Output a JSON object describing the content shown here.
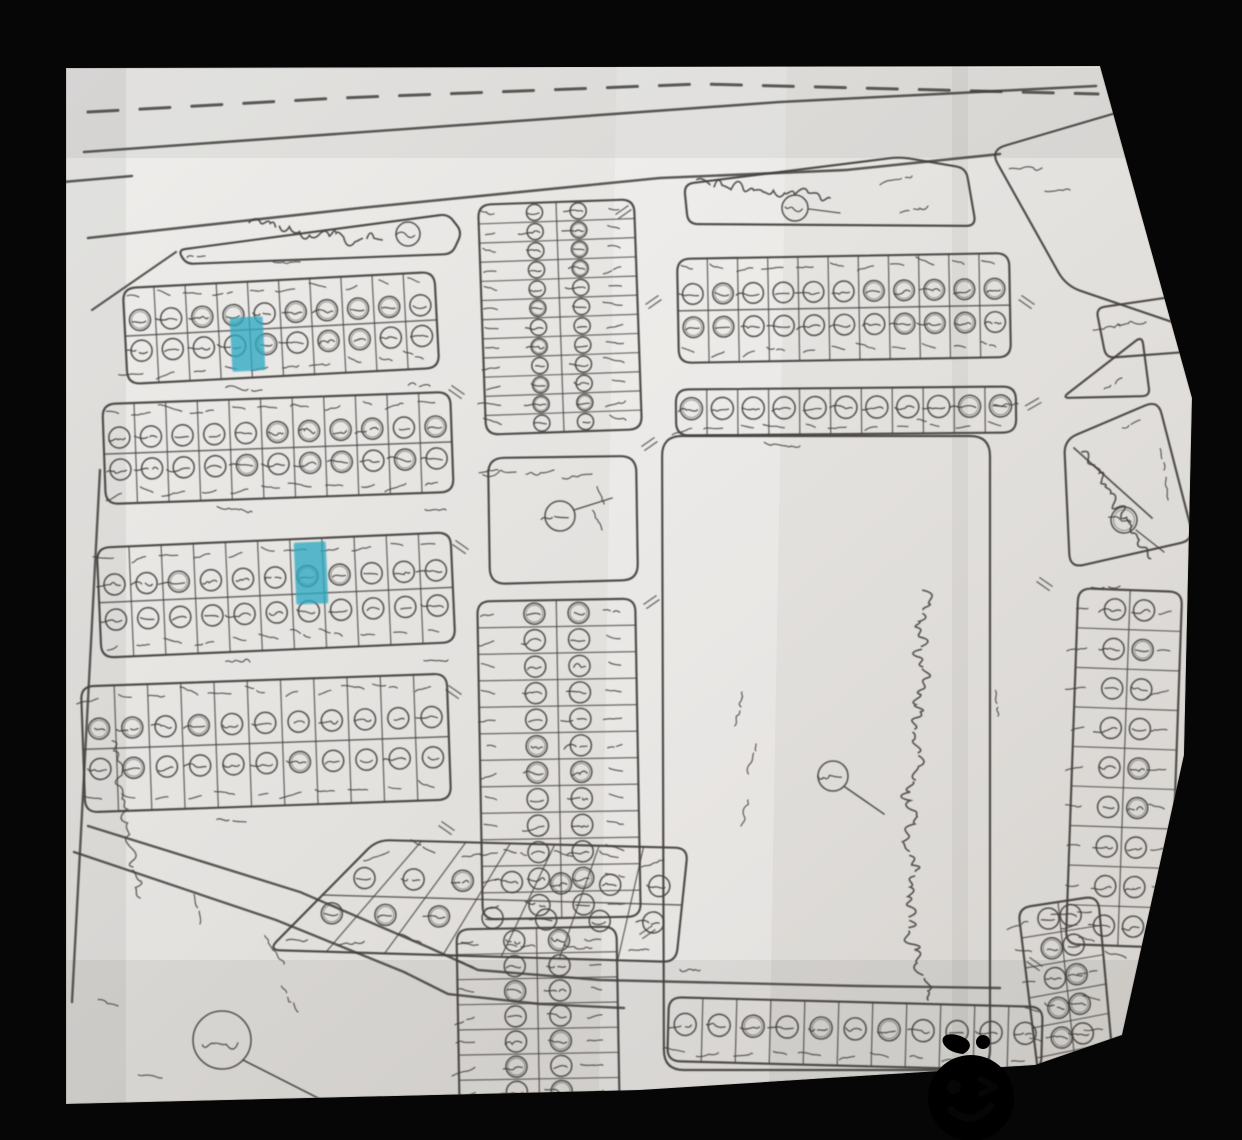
{
  "meta": {
    "kind": "scanned hand-drawn cadastral plot map photographed on a black background",
    "script": "Arabic / Kurdish handwriting"
  },
  "palette": {
    "background": "#060606",
    "paper_light": "#efeeec",
    "paper_mid": "#e4e2df",
    "paper_dark": "#d7d4d0",
    "ink": "#413f3c",
    "highlight": "#2fa9c2",
    "red_note": "#d9484f",
    "marker": "#141414",
    "logo_orange": "#fd4e02"
  },
  "paper": {
    "outline": [
      [
        66,
        68
      ],
      [
        1100,
        66
      ],
      [
        1192,
        398
      ],
      [
        1184,
        755
      ],
      [
        1122,
        1035
      ],
      [
        1035,
        1065
      ],
      [
        640,
        1090
      ],
      [
        66,
        1104
      ]
    ]
  },
  "roads": [
    {
      "name": "highway-dashed-centerline",
      "points": [
        [
          88,
          112
        ],
        [
          340,
          98
        ],
        [
          700,
          84
        ],
        [
          1098,
          94
        ]
      ],
      "width": 3,
      "dash": [
        30,
        22
      ]
    },
    {
      "name": "highway-north-edge",
      "points": [
        [
          84,
          152
        ],
        [
          420,
          128
        ],
        [
          780,
          102
        ],
        [
          1096,
          86
        ]
      ],
      "width": 2.6
    },
    {
      "name": "highway-south-edge",
      "points": [
        [
          88,
          238
        ],
        [
          360,
          208
        ],
        [
          660,
          178
        ],
        [
          846,
          170
        ],
        [
          1000,
          154
        ]
      ],
      "width": 2.6
    },
    {
      "name": "west-spur",
      "points": [
        [
          92,
          310
        ],
        [
          176,
          252
        ]
      ],
      "width": 2.2
    },
    {
      "name": "west-boundary",
      "points": [
        [
          100,
          470
        ],
        [
          88,
          700
        ],
        [
          72,
          1002
        ]
      ],
      "width": 2.4
    },
    {
      "name": "sw-road-upper",
      "points": [
        [
          88,
          826
        ],
        [
          300,
          892
        ],
        [
          430,
          948
        ],
        [
          478,
          970
        ],
        [
          600,
          980
        ],
        [
          860,
          986
        ],
        [
          1000,
          988
        ]
      ],
      "width": 2.4
    },
    {
      "name": "sw-road-lower",
      "points": [
        [
          74,
          852
        ],
        [
          276,
          920
        ],
        [
          404,
          972
        ],
        [
          448,
          994
        ],
        [
          540,
          1004
        ],
        [
          624,
          1008
        ]
      ],
      "width": 2.4
    },
    {
      "name": "left-edge-dash",
      "points": [
        [
          63,
          182
        ],
        [
          132,
          176
        ]
      ],
      "width": 2.4
    }
  ],
  "blocks": [
    {
      "id": "block-a",
      "kind": "grid",
      "rect": [
        125,
        280,
        312,
        96
      ],
      "rot": -3,
      "cols": 10,
      "rows": 2,
      "layout": "rows2"
    },
    {
      "id": "block-b",
      "kind": "grid",
      "rect": [
        104,
        398,
        348,
        100
      ],
      "rot": -2,
      "cols": 11,
      "rows": 2,
      "layout": "rows2"
    },
    {
      "id": "block-c",
      "kind": "grid",
      "rect": [
        99,
        540,
        354,
        110
      ],
      "rot": -2.5,
      "cols": 11,
      "rows": 2,
      "layout": "rows2"
    },
    {
      "id": "block-d",
      "kind": "grid",
      "rect": [
        83,
        680,
        366,
        126
      ],
      "rot": -2,
      "cols": 11,
      "rows": 2,
      "layout": "rows2"
    },
    {
      "id": "strip-north",
      "kind": "grid",
      "rect": [
        482,
        202,
        156,
        230
      ],
      "rot": -2,
      "cols": 2,
      "rows": 12,
      "layout": "cols2"
    },
    {
      "id": "mosque-square",
      "kind": "outline",
      "corners": [
        [
          488,
          458
        ],
        [
          636,
          456
        ],
        [
          638,
          580
        ],
        [
          490,
          584
        ]
      ],
      "radius": 16,
      "marks": [
        {
          "kind": "circle",
          "x": 560,
          "y": 516,
          "r": 15
        },
        {
          "kind": "line",
          "pts": [
            [
              574,
              510
            ],
            [
              612,
              498
            ]
          ],
          "w": 1.4
        },
        {
          "kind": "squiggle",
          "x": 516,
          "y": 472,
          "s": 12,
          "rot": -5
        },
        {
          "kind": "squiggle",
          "x": 554,
          "y": 470,
          "s": 11,
          "rot": -5
        },
        {
          "kind": "squiggle",
          "x": 592,
          "y": 474,
          "s": 11,
          "rot": -3
        },
        {
          "kind": "squiggle",
          "x": 498,
          "y": 470,
          "s": 7,
          "rot": 0
        },
        {
          "kind": "squiggle",
          "x": 604,
          "y": 504,
          "s": 8,
          "rot": 70
        },
        {
          "kind": "squiggle",
          "x": 602,
          "y": 530,
          "s": 8,
          "rot": 70
        }
      ]
    },
    {
      "id": "strip-mid",
      "kind": "grid",
      "rect": [
        480,
        600,
        158,
        318
      ],
      "rot": -1,
      "cols": 2,
      "rows": 12,
      "layout": "cols2"
    },
    {
      "id": "strip-south",
      "kind": "grid",
      "rect": [
        458,
        928,
        160,
        176
      ],
      "rot": -1,
      "cols": 2,
      "rows": 7,
      "layout": "cols2"
    },
    {
      "id": "block-f",
      "kind": "grid",
      "rect": [
        678,
        256,
        332,
        104
      ],
      "rot": -1,
      "cols": 11,
      "rows": 2,
      "layout": "rows2"
    },
    {
      "id": "row-g",
      "kind": "grid",
      "rect": [
        676,
        388,
        340,
        46
      ],
      "rot": -0.5,
      "cols": 11,
      "rows": 1,
      "layout": "single"
    },
    {
      "id": "field",
      "kind": "outline",
      "corners": [
        [
          662,
          436
        ],
        [
          990,
          436
        ],
        [
          990,
          1070
        ],
        [
          664,
          1070
        ]
      ],
      "radius": 20,
      "marks": [
        {
          "kind": "squiggle",
          "x": 800,
          "y": 446,
          "s": 15,
          "rot": 0
        },
        {
          "kind": "script",
          "x": 928,
          "y": 1000,
          "len": 400,
          "rot": 90,
          "size": 13
        },
        {
          "kind": "squiggle",
          "x": 742,
          "y": 692,
          "s": 13,
          "rot": -75
        },
        {
          "kind": "squiggle",
          "x": 756,
          "y": 744,
          "s": 11,
          "rot": -75
        },
        {
          "kind": "squiggle",
          "x": 748,
          "y": 800,
          "s": 12,
          "rot": -75
        },
        {
          "kind": "circle",
          "x": 833,
          "y": 776,
          "r": 15
        },
        {
          "kind": "line",
          "pts": [
            [
              845,
              787
            ],
            [
              884,
              814
            ]
          ],
          "w": 1.6
        }
      ]
    },
    {
      "id": "row-h",
      "kind": "grid",
      "rect": [
        668,
        1002,
        374,
        64
      ],
      "rot": 1.5,
      "cols": 11,
      "rows": 1,
      "layout": "single"
    },
    {
      "id": "block-e",
      "kind": "gridq",
      "corners": [
        [
          377,
          840
        ],
        [
          688,
          848
        ],
        [
          676,
          962
        ],
        [
          268,
          950
        ]
      ],
      "cols": 7,
      "rows": 2,
      "layout": "rows2"
    },
    {
      "id": "sliver",
      "kind": "outline",
      "corners": [
        [
          178,
          250
        ],
        [
          448,
          214
        ],
        [
          462,
          232
        ],
        [
          452,
          254
        ],
        [
          186,
          264
        ]
      ],
      "radius": 8,
      "marks": [
        {
          "kind": "script",
          "x": 382,
          "y": 240,
          "len": 130,
          "rot": 6,
          "size": 8
        },
        {
          "kind": "circle",
          "x": 408,
          "y": 234,
          "r": 12
        }
      ]
    },
    {
      "id": "north-trap",
      "kind": "outline",
      "corners": [
        [
          684,
          184
        ],
        [
          900,
          157
        ],
        [
          966,
          168
        ],
        [
          976,
          226
        ],
        [
          688,
          224
        ]
      ],
      "radius": 10,
      "marks": [
        {
          "kind": "script",
          "x": 830,
          "y": 198,
          "len": 120,
          "rot": 8,
          "size": 9
        },
        {
          "kind": "circle",
          "x": 795,
          "y": 208,
          "r": 13
        },
        {
          "kind": "line",
          "pts": [
            [
              809,
              209
            ],
            [
              840,
              213
            ]
          ],
          "w": 1.3
        },
        {
          "kind": "squiggle",
          "x": 912,
          "y": 176,
          "s": 11,
          "rot": -20
        },
        {
          "kind": "squiggle",
          "x": 928,
          "y": 206,
          "s": 11,
          "rot": -20
        }
      ]
    },
    {
      "id": "ne-block",
      "kind": "outline",
      "corners": [
        [
          990,
          150
        ],
        [
          1150,
          103
        ],
        [
          1196,
          330
        ],
        [
          1066,
          286
        ]
      ],
      "radius": 16,
      "marks": [
        {
          "kind": "squiggle",
          "x": 1042,
          "y": 168,
          "s": 13,
          "rot": -10
        },
        {
          "kind": "squiggle",
          "x": 1070,
          "y": 190,
          "s": 11,
          "rot": -10
        }
      ]
    },
    {
      "id": "ne-corner",
      "kind": "outline",
      "corners": [
        [
          1096,
          308
        ],
        [
          1178,
          296
        ],
        [
          1186,
          352
        ],
        [
          1106,
          358
        ]
      ],
      "radius": 9,
      "marks": [
        {
          "kind": "squiggle",
          "x": 1120,
          "y": 326,
          "s": 10,
          "rot": -8
        },
        {
          "kind": "squiggle",
          "x": 1146,
          "y": 322,
          "s": 9,
          "rot": -8
        }
      ]
    },
    {
      "id": "ne-triangle",
      "kind": "outline",
      "corners": [
        [
          1062,
          398
        ],
        [
          1142,
          336
        ],
        [
          1150,
          396
        ]
      ],
      "radius": 8,
      "marks": [
        {
          "kind": "squiggle",
          "x": 1122,
          "y": 378,
          "s": 9,
          "rot": -35
        }
      ]
    },
    {
      "id": "east-block",
      "kind": "outline",
      "corners": [
        [
          1064,
          440
        ],
        [
          1158,
          400
        ],
        [
          1194,
          540
        ],
        [
          1070,
          568
        ]
      ],
      "radius": 14,
      "marks": [
        {
          "kind": "line",
          "pts": [
            [
              1074,
              448
            ],
            [
              1152,
              518
            ]
          ],
          "w": 1.8
        },
        {
          "kind": "script",
          "x": 1082,
          "y": 452,
          "len": 120,
          "rot": -125,
          "size": 9
        },
        {
          "kind": "circle",
          "x": 1124,
          "y": 520,
          "r": 13
        },
        {
          "kind": "line",
          "pts": [
            [
              1136,
              530
            ],
            [
              1164,
              552
            ]
          ],
          "w": 1.4
        },
        {
          "kind": "squiggle",
          "x": 1164,
          "y": 470,
          "s": 8,
          "rot": 85
        },
        {
          "kind": "squiggle",
          "x": 1168,
          "y": 500,
          "s": 8,
          "rot": 85
        },
        {
          "kind": "squiggle",
          "x": 1140,
          "y": 420,
          "s": 8,
          "rot": -30
        }
      ]
    },
    {
      "id": "east-col",
      "kind": "grid",
      "rect": [
        1072,
        590,
        104,
        356
      ],
      "rot": 2,
      "cols": 2,
      "rows": 9,
      "layout": "cols2"
    },
    {
      "id": "se-col",
      "kind": "gridq",
      "corners": [
        [
          1018,
          908
        ],
        [
          1098,
          896
        ],
        [
          1114,
          1072
        ],
        [
          1040,
          1088
        ]
      ],
      "cols": 2,
      "rows": 6,
      "layout": "cols2"
    }
  ],
  "marks": [
    {
      "kind": "tick",
      "x": 458,
      "y": 390,
      "rot": 35
    },
    {
      "kind": "tick",
      "x": 462,
      "y": 545,
      "rot": 35
    },
    {
      "kind": "tick",
      "x": 455,
      "y": 690,
      "rot": 35
    },
    {
      "kind": "tick",
      "x": 448,
      "y": 826,
      "rot": 35
    },
    {
      "kind": "tick",
      "x": 652,
      "y": 300,
      "rot": -35
    },
    {
      "kind": "tick",
      "x": 648,
      "y": 442,
      "rot": -35
    },
    {
      "kind": "tick",
      "x": 650,
      "y": 600,
      "rot": -35
    },
    {
      "kind": "tick",
      "x": 646,
      "y": 930,
      "rot": -35
    },
    {
      "kind": "tick",
      "x": 1028,
      "y": 300,
      "rot": 35
    },
    {
      "kind": "tick",
      "x": 1032,
      "y": 402,
      "rot": -30
    },
    {
      "kind": "tick",
      "x": 1046,
      "y": 582,
      "rot": 35
    },
    {
      "kind": "tick",
      "x": 1036,
      "y": 962,
      "rot": 35
    },
    {
      "kind": "tick",
      "x": 622,
      "y": 210,
      "rot": -35
    },
    {
      "kind": "squiggle",
      "x": 262,
      "y": 390,
      "s": 13,
      "rot": 2
    },
    {
      "kind": "squiggle",
      "x": 430,
      "y": 386,
      "s": 9,
      "rot": 2
    },
    {
      "kind": "squiggle",
      "x": 252,
      "y": 512,
      "s": 12,
      "rot": 2
    },
    {
      "kind": "squiggle",
      "x": 446,
      "y": 510,
      "s": 9,
      "rot": 2
    },
    {
      "kind": "squiggle",
      "x": 250,
      "y": 662,
      "s": 12,
      "rot": 2
    },
    {
      "kind": "squiggle",
      "x": 448,
      "y": 660,
      "s": 9,
      "rot": 2
    },
    {
      "kind": "squiggle",
      "x": 246,
      "y": 822,
      "s": 11,
      "rot": 2
    },
    {
      "kind": "squiggle",
      "x": 700,
      "y": 970,
      "s": 10,
      "rot": 3
    },
    {
      "kind": "squiggle",
      "x": 998,
      "y": 716,
      "s": 12,
      "rot": 85
    },
    {
      "kind": "squiggle",
      "x": 1018,
      "y": 404,
      "s": 9,
      "rot": -5
    },
    {
      "kind": "squiggle",
      "x": 300,
      "y": 262,
      "s": 11,
      "rot": -4
    },
    {
      "kind": "squiggle",
      "x": 205,
      "y": 256,
      "s": 7,
      "rot": -8
    },
    {
      "kind": "squiggle",
      "x": 1120,
      "y": 586,
      "s": 9,
      "rot": -5
    },
    {
      "kind": "squiggle",
      "x": 1126,
      "y": 958,
      "s": 9,
      "rot": 20
    },
    {
      "kind": "circle",
      "x": 222,
      "y": 1040,
      "r": 29
    },
    {
      "kind": "line",
      "pts": [
        [
          243,
          1060
        ],
        [
          318,
          1098
        ]
      ],
      "w": 1.8
    },
    {
      "kind": "squiggle",
      "x": 200,
      "y": 924,
      "s": 12,
      "rot": 78
    },
    {
      "kind": "squiggle",
      "x": 284,
      "y": 964,
      "s": 15,
      "rot": 55
    },
    {
      "kind": "squiggle",
      "x": 298,
      "y": 1012,
      "s": 13,
      "rot": 55
    },
    {
      "kind": "wave",
      "x": 140,
      "y": 898,
      "len": 150,
      "rot": 82
    },
    {
      "kind": "squiggle",
      "x": 118,
      "y": 1006,
      "s": 11,
      "rot": 15
    },
    {
      "kind": "squiggle",
      "x": 162,
      "y": 1078,
      "s": 10,
      "rot": 5
    }
  ],
  "highlighted_plots": [
    {
      "id": "highlight-1",
      "block": "block-a",
      "x": 231,
      "y": 317,
      "w": 33,
      "h": 54,
      "rot": -3
    },
    {
      "id": "highlight-2",
      "block": "block-c",
      "x": 295,
      "y": 542,
      "w": 32,
      "h": 62,
      "rot": -2.5
    }
  ],
  "marker_line": {
    "points": [
      [
        843,
        224
      ],
      [
        830,
        248
      ],
      [
        818,
        272
      ],
      [
        808,
        306
      ],
      [
        800,
        340
      ],
      [
        795,
        370
      ],
      [
        792,
        398
      ],
      [
        796,
        418
      ],
      [
        806,
        433
      ]
    ],
    "width": 9
  },
  "annotations": {
    "red_note": {
      "text": "ئەم زەوییە",
      "legible": true
    },
    "vertical_note": {
      "description": "long handwritten Kurdish note written vertically inside the empty field",
      "legible": false
    },
    "plot_numbers": {
      "description": "every parcel carries a small circled handwritten plot number",
      "legible": false
    }
  },
  "watermark": {
    "text": "NARNJ",
    "icon": "orange-fruit-winking-face",
    "color": "#fd4e02"
  }
}
